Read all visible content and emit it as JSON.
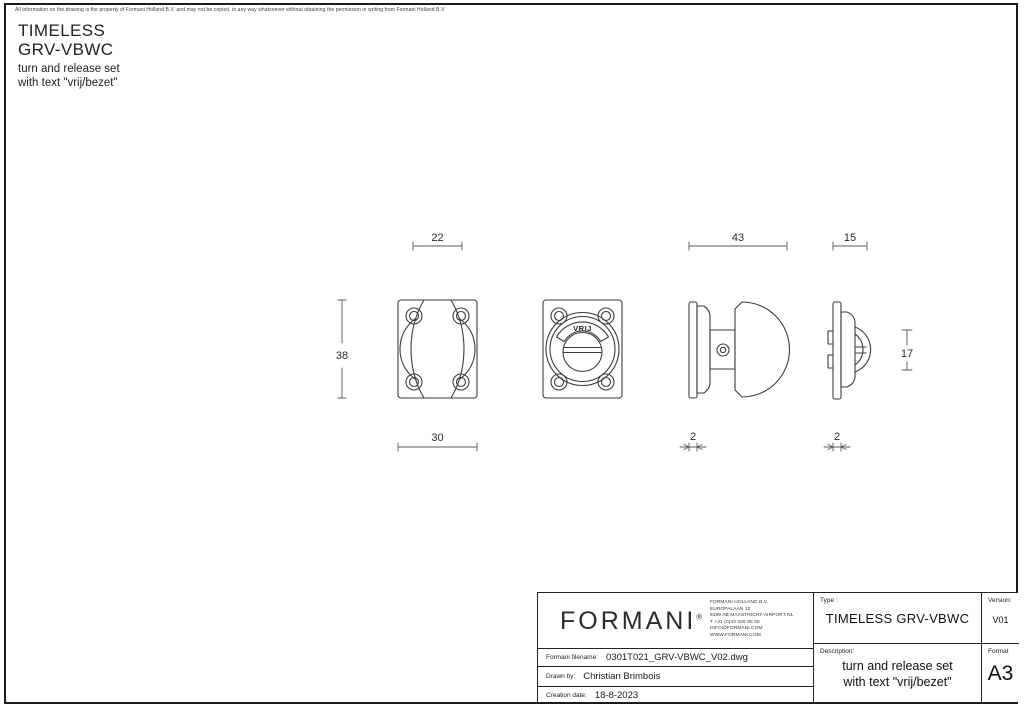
{
  "page": {
    "disclaimer": "All information on the drawing is the property of Formani Holland B.V. and may not be copied, in any way whatsoever without obtaining the permission in writing from Formani Holland B.V",
    "title_line1": "TIMELESS",
    "title_line2": "GRV-VBWC",
    "subtitle_line1": "turn and release set",
    "subtitle_line2": "with text \"vrij/bezet\""
  },
  "drawing": {
    "vrij_label": "VRIJ",
    "dims": {
      "knob_width": "22",
      "rosette_height": "38",
      "rosette_width": "30",
      "turn_depth": "43",
      "turn_plate_thickness": "2",
      "release_depth": "15",
      "release_plate_thickness": "2",
      "release_knob_height": "17"
    }
  },
  "title_block": {
    "logo_text": "FORMANI",
    "logo_reg": "®",
    "address_lines": [
      "FORMANI HOLLAND B.V.",
      "EUROPALAAN 12",
      "6199 AB MAASTRICHT-AIRPORT NL",
      "T +31 (0)43 328 90 00",
      "INFO@FORMANI.COM",
      "WWW.FORMANI.COM"
    ],
    "filename_label": "Formani filename:",
    "filename_value": "0301T021_GRV-VBWC_V02.dwg",
    "drawn_by_label": "Drawn by:",
    "drawn_by_value": "Christian Brimbois",
    "creation_label": "Creation date:",
    "creation_value": "18-8-2023",
    "type_label": "Type :",
    "type_value": "TIMELESS GRV-VBWC",
    "version_label": "Version:",
    "version_value": "V01",
    "description_label": "Description:",
    "description_line1": "turn and release set",
    "description_line2": "with text \"vrij/bezet\"",
    "format_label": "Format",
    "format_value": "A3"
  },
  "colors": {
    "line": "#3c3c3c",
    "dim_line": "#5a5a5a",
    "text": "#1a1a1a",
    "background": "#ffffff"
  }
}
